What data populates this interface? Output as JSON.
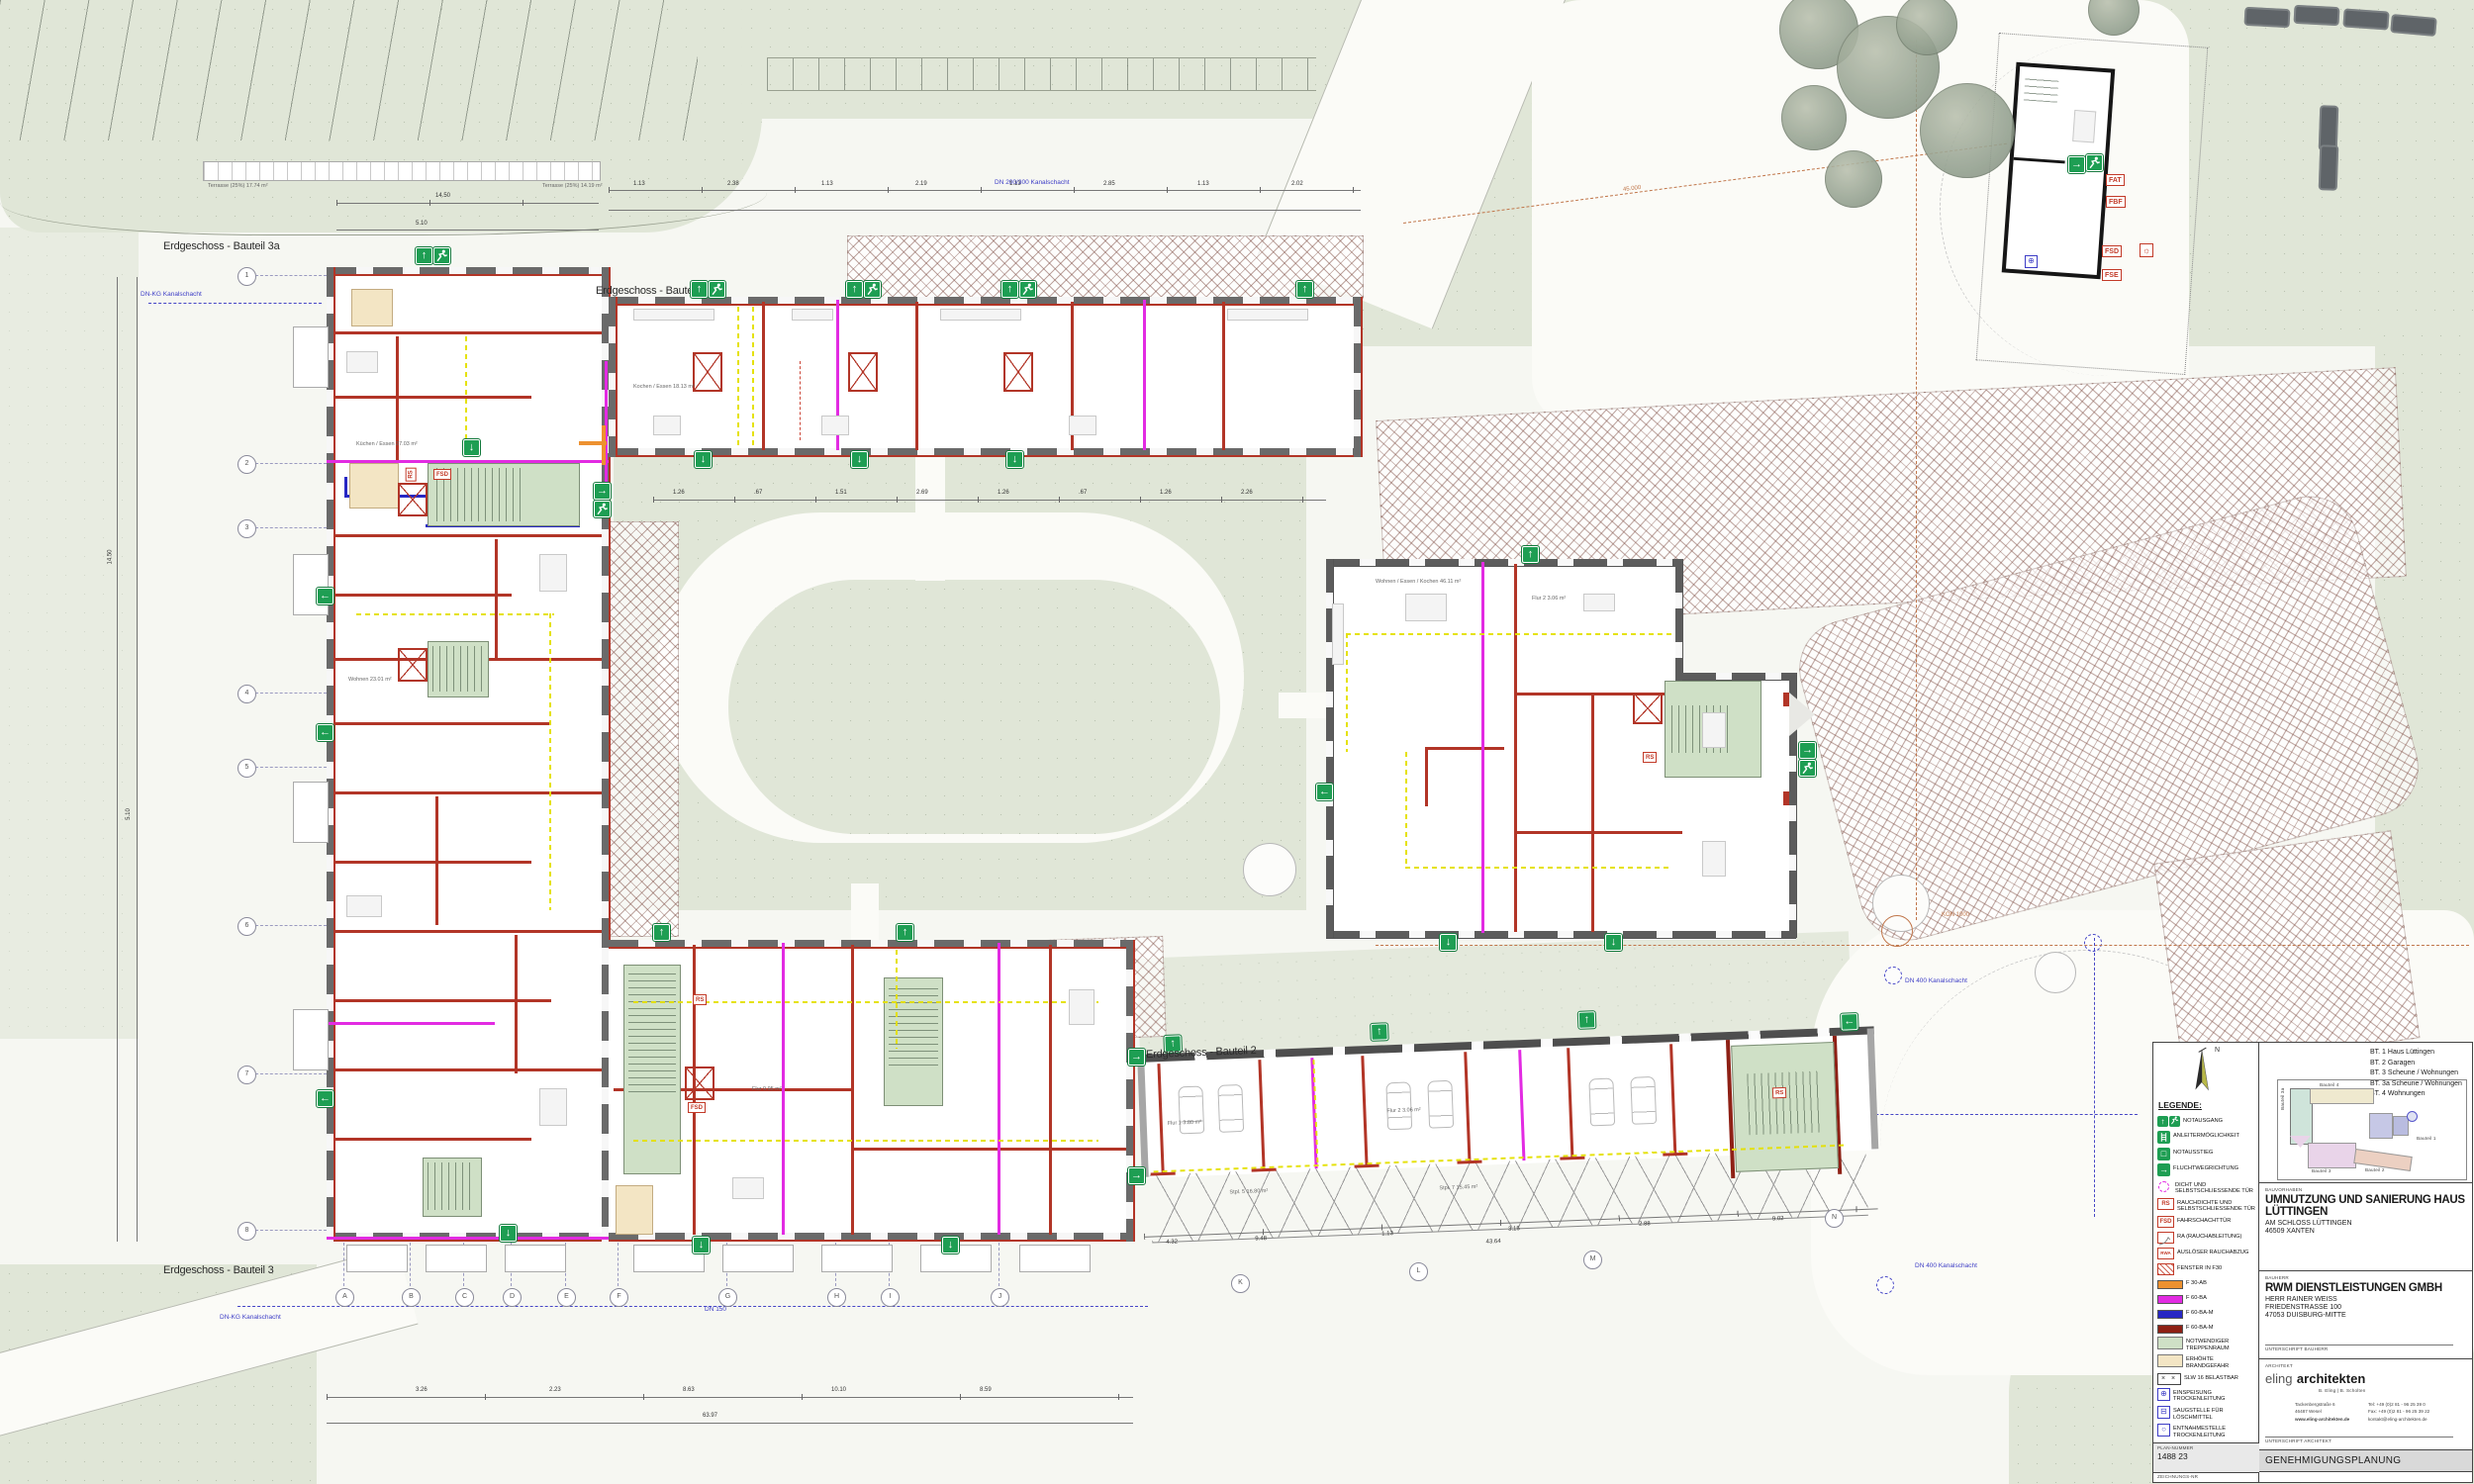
{
  "plan": {
    "floor_labels": {
      "bt3a": "Erdgeschoss - Bauteil 3a",
      "bt4": "Erdgeschoss - Bauteil 4",
      "bt2": "Erdgeschoss - Bauteil 2",
      "bt3": "Erdgeschoss - Bauteil 3"
    },
    "grid": {
      "rows": [
        "1",
        "2",
        "3",
        "4",
        "5",
        "6",
        "7",
        "8"
      ],
      "cols": [
        "A",
        "B",
        "C",
        "D",
        "E",
        "F",
        "G",
        "H",
        "I",
        "J"
      ],
      "cols2": [
        "K",
        "L",
        "M",
        "N"
      ]
    },
    "icons": {
      "up": "↑",
      "down": "↓",
      "left": "←",
      "right": "→"
    },
    "tags": {
      "rs": "RS",
      "fsd": "FSD",
      "fat": "FAT",
      "fbf": "FBF",
      "fse": "FSE",
      "sun": "☼"
    },
    "annotations": {
      "kanal_kg": "DN-KG Kanalschacht",
      "kanal400": "DN 400 Kanalschacht",
      "kanal23": "DN 200/300 Kanalschacht",
      "dn150": "DN 150",
      "kon1000": "KON 1000",
      "radius45": "45.000",
      "terr1": "Terrasse (25%)   17.74 m²",
      "terr2": "Terrasse (25%)   14.19 m²"
    },
    "rooms": {
      "flur1": "Flur 1   3.80 m²",
      "flur2": "Flur 2   3.06 m²",
      "stpl5": "Stpl. 5   16.80 m²",
      "stpl7": "Stpl. 7   15.45 m²",
      "wek": "Wohnen / Essen / Kochen   46.11 m²",
      "wohnen": "Wohnen   23.01 m²",
      "kueche": "Küchen / Essen   27.03 m²",
      "kochen4": "Kochen / Essen   18.13 m²",
      "flurb1": "Flur   9.95 m²"
    },
    "dims": {
      "top": [
        "1.13",
        "2.38",
        "1.13",
        "2.19",
        "1.13",
        "2.85",
        "1.13",
        "2.02"
      ],
      "court": [
        "1.26",
        ".67",
        "1.51",
        "2.69",
        "1.26",
        ".67",
        "1.26",
        "2.26"
      ],
      "bottom": [
        "3.26",
        "2.23",
        "8.63",
        "10.10",
        "8.59"
      ],
      "bottom_total": "63.97",
      "left": [
        "14.50",
        "5.10"
      ],
      "garage": [
        "4.32",
        "9.48",
        "1.13",
        "3.15",
        "2.88",
        "9.02"
      ],
      "garage_total": "43.64"
    }
  },
  "legend": {
    "title": "LEGENDE:",
    "items": [
      {
        "label": "NOTAUSGANG"
      },
      {
        "label": "ANLEITERMÖGLICHKEIT"
      },
      {
        "label": "NOTAUSSTIEG",
        "glyph": "□"
      },
      {
        "label": "FLUCHTWEGRICHTUNG",
        "glyph": "→"
      },
      {
        "label": "DICHT UND SELBSTSCHLIESSENDE TÜR"
      },
      {
        "label": "RAUCHDICHTE UND SELBSTSCHLIESSENDE TÜR",
        "glyph": "RS"
      },
      {
        "label": "FAHRSCHACHTTÜR",
        "glyph": "FSD"
      },
      {
        "label": "RA (RAUCHABLEITUNG)"
      },
      {
        "label": "AUSLÖSER RAUCHABZUG",
        "glyph": "RWA"
      },
      {
        "label": "FENSTER IN F30"
      },
      {
        "label": "F 30-AB"
      },
      {
        "label": "F 60-BA"
      },
      {
        "label": "F 60-BA-M"
      },
      {
        "label": "F 60-BA-M"
      },
      {
        "label": "NOTWENDIGER TREPPENRAUM"
      },
      {
        "label": "ERHÖHTE BRANDGEFAHR"
      },
      {
        "label": "SLW 16 BELASTBAR",
        "glyph": "× ×"
      },
      {
        "label": "EINSPEISUNG TROCKENLEITUNG",
        "glyph": "⊕"
      },
      {
        "label": "SAUGSTELLE FÜR LÖSCHMITTEL",
        "glyph": "⊟"
      },
      {
        "label": "ENTNAHMESTELLE TROCKENLEITUNG",
        "glyph": "○"
      }
    ]
  },
  "titleblock": {
    "north": "N",
    "bt_list": [
      "BT. 1 Haus Lüttingen",
      "BT. 2 Garagen",
      "BT. 3 Scheune / Wohnungen",
      "BT. 3a Scheune / Wohnungen",
      "BT. 4 Wohnungen"
    ],
    "keyplan_labels": {
      "b4": "Bauteil 4",
      "b3a": "Bauteil 3a",
      "b3": "Bauteil 3",
      "b2": "Bauteil 2",
      "b1": "Bauteil 1"
    },
    "bauvorhaben_label": "BAUVORHABEN",
    "project": "UMNUTZUNG UND SANIERUNG HAUS LÜTTINGEN",
    "street": "AM SCHLOSS LÜTTINGEN",
    "city": "46509 XANTEN",
    "bauherr_label": "BAUHERR",
    "client": "RWM DIENSTLEISTUNGEN GMBH",
    "client2": "HERR RAINER WEISS",
    "client3": "FRIEDENSTRASSE 100",
    "client4": "47053 DUISBURG-MITTE",
    "sig_client": "UNTERSCHRIFT BAUHERR",
    "architekt_label": "ARCHITEKT",
    "firm1": "eling",
    "firm2": "architekten",
    "firm_sub": "B. Eling  |  B. Scholten",
    "addr1": "Tackenbergstraße 6",
    "addr2": "46487 Wesel",
    "web": "www.eling-architekten.de",
    "tel": "Tel:  +49 (0)2 81 - 96 25 39 0",
    "fax": "Fax: +49 (0)2 81 - 96 25 39 22",
    "mail": "kontakt@eling-architekten.de",
    "sig_arch": "UNTERSCHRIFT ARCHITEKT",
    "plannr_label": "PLAN-NUMMER",
    "plannr": "1488 23",
    "zeichnr_label": "ZEICHNUNGS-NR",
    "phase": "GENEHMIGUNGSPLANUNG"
  }
}
